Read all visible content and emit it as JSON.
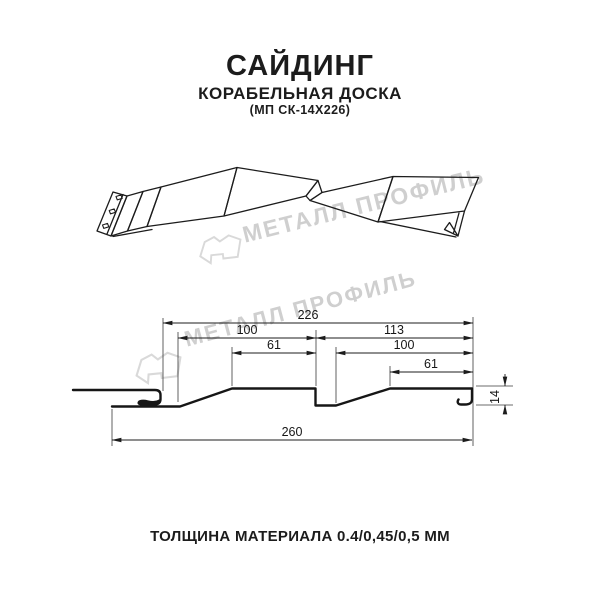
{
  "header": {
    "title": "САЙДИНГ",
    "subtitle": "КОРАБЕЛЬНАЯ ДОСКА",
    "model_code": "(МП СК-14Х226)"
  },
  "footer": {
    "thickness": "ТОЛЩИНА МАТЕРИАЛА 0.4/0,45/0,5 ММ"
  },
  "watermark": {
    "brand": "МЕТАЛЛ ПРОФИЛЬ",
    "color": "#cfcfcf"
  },
  "cross_section": {
    "dims": {
      "overall_top": "226",
      "left_board": "100",
      "right_board": "113",
      "left_board_top": "61",
      "right_board_inner": "100",
      "right_board_top": "61",
      "total_width": "260",
      "height": "14"
    }
  },
  "colors": {
    "line": "#1c1c1c",
    "background": "#ffffff",
    "watermark": "#cfcfcf"
  }
}
